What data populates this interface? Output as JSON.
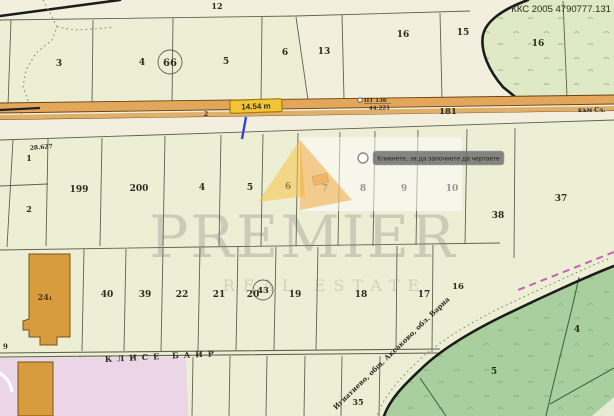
{
  "colors": {
    "canvas": "#f2efdf",
    "parcel": "#ecefd4",
    "road_fill": "#e3a75c",
    "road_fill2": "#e0b06b",
    "road_edge": "#6b4310",
    "badge_bg": "#f2c437",
    "badge_border": "#a87808",
    "forest": "#aacf9e",
    "forest_light": "#dfe9c6",
    "pink_zone": "#ead6e6",
    "building": "#d89b3e",
    "marker_blue": "#3344dd",
    "railway_pink": "#c75fb5"
  },
  "header": {
    "ref_code": "ККС 2005 4790777.131"
  },
  "tooltip": {
    "text": "Кликнете, за да започнете да чертаете"
  },
  "watermark": {
    "brand": "PREMIER",
    "tagline": "REAL ESTATE"
  },
  "road": {
    "width_label": "14.54 m",
    "road_number": "181",
    "survey_point": "ПТ 136",
    "distance": "44.221",
    "distance_left": "28.627",
    "km_mark": "2",
    "direction": "към Сл."
  },
  "labels": {
    "area_name": "КЛИСЕ БАИР",
    "place_name": "Игнатиево, общ. Аксаково, обл. Варна",
    "edge_parcel": "9"
  },
  "parcels": {
    "top": {
      "p12": "12",
      "p3": "3",
      "p4": "4",
      "p66": "66",
      "p5": "5",
      "p6": "6",
      "p13": "13",
      "p16": "16",
      "p15": "15",
      "p16b": "16"
    },
    "mid": {
      "p1": "1",
      "p2": "2",
      "p199": "199",
      "p200": "200",
      "p4": "4",
      "p5": "5",
      "p6": "6",
      "p7": "7",
      "p8": "8",
      "p9": "9",
      "p10": "10",
      "p38": "38",
      "p37": "37"
    },
    "low": {
      "p24": "24₁",
      "p40": "40",
      "p39": "39",
      "p22": "22",
      "p21": "21",
      "p20": "20",
      "p43": "43",
      "p19": "19",
      "p18": "18",
      "p17": "17",
      "p16": "16",
      "p35": "35"
    },
    "forest": {
      "p5": "5",
      "p4": "4"
    }
  }
}
